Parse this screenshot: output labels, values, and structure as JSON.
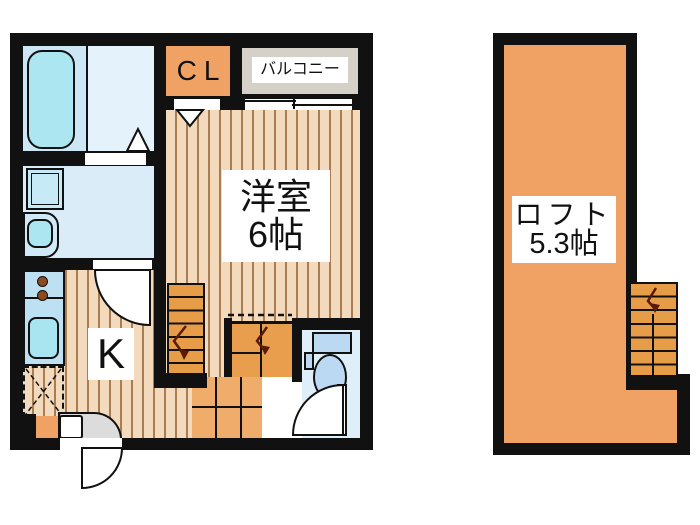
{
  "title": "apartment floor plan with loft",
  "first_floor": {
    "western_room": {
      "label": "洋室",
      "size": "6帖"
    },
    "kitchen": {
      "label": "K"
    },
    "closet": {
      "label": "CL"
    },
    "balcony": {
      "label": "バルコニー"
    }
  },
  "loft": {
    "label": "ロフト",
    "size": "5.3帖"
  },
  "colors": {
    "wall": "#111111",
    "room_orange": "#f0a264",
    "stair_orange": "#e79c47",
    "hall_orange": "#e89e4d",
    "landing_orange": "#f0ac6b",
    "wood_floor": "#f4dabc",
    "wood_grain_line": "#a87d52",
    "water_room_blue": "#d9ecf8",
    "bath_floor_blue": "#e4f2fb",
    "fixture_cyan": "#abe6f1",
    "toilet_fixture_blue": "#bcd9f3",
    "balcony_gray": "#d5d1c9",
    "entrance_gray": "#dcdcdc"
  }
}
